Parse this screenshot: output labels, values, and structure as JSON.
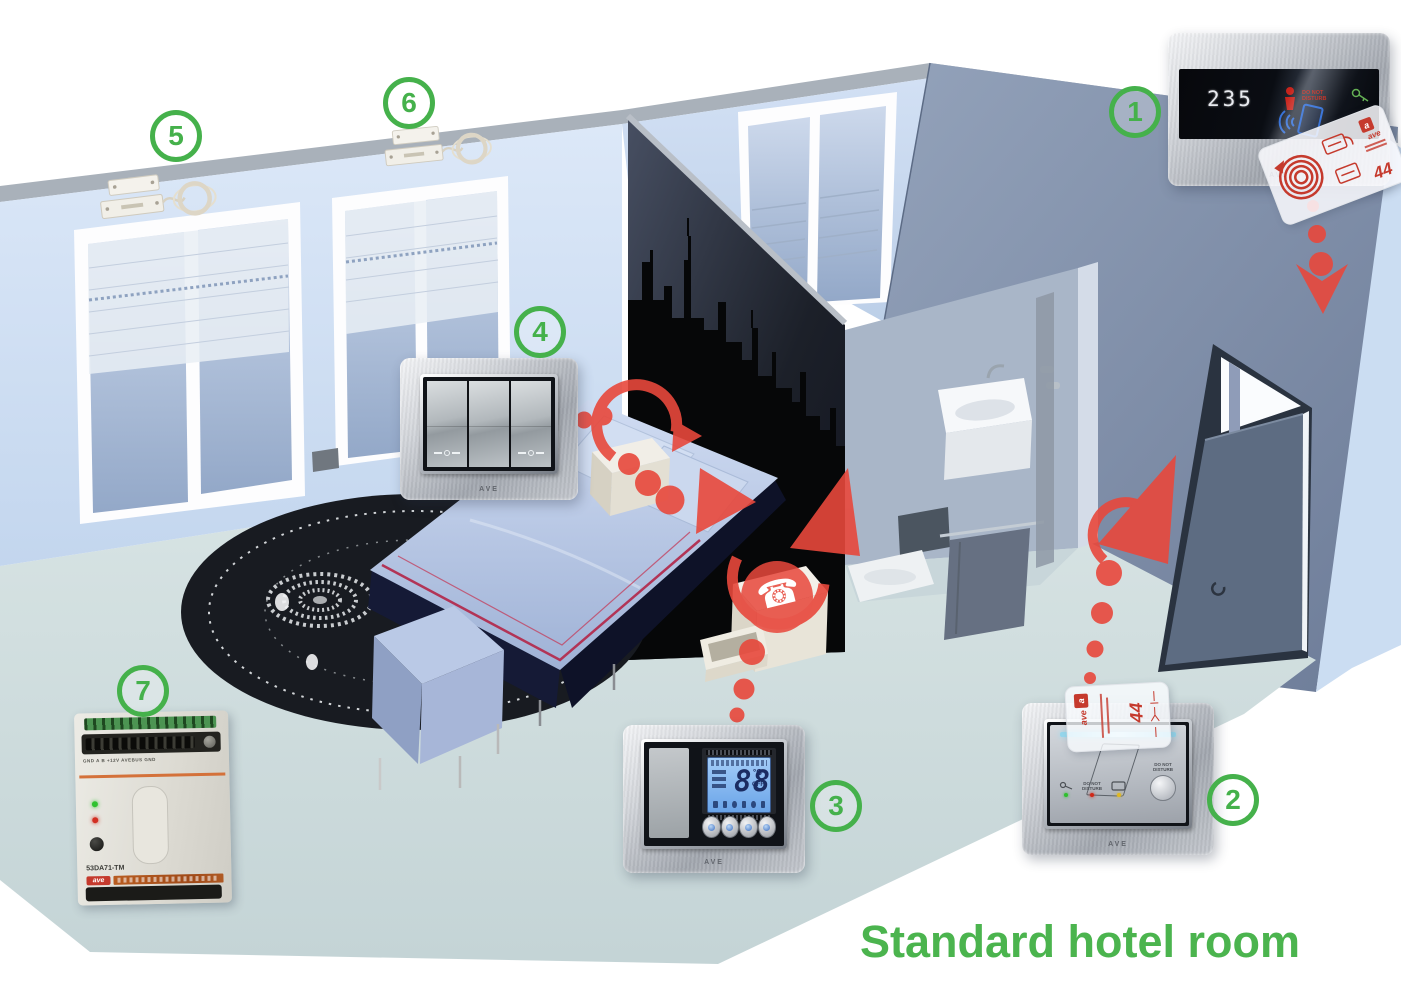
{
  "title": {
    "text": "Standard hotel room"
  },
  "badges": [
    "1",
    "2",
    "3",
    "4",
    "5",
    "6",
    "7"
  ],
  "brand": {
    "panel": "AVE",
    "module": "ave",
    "logo_letter": "a"
  },
  "icons": {
    "phone": "☎"
  },
  "dnd": {
    "line1": "DO NOT",
    "line2": "DISTURB"
  },
  "access_reader": {
    "room_number": "235"
  },
  "keycard": {
    "number": "44",
    "brand": "ave"
  },
  "thermostat": {
    "reading": "888",
    "unit": "°C",
    "off_label": "OFF"
  },
  "din_module": {
    "model": "53DA71-TM",
    "terminals": "GND A B +12V AVEBUS GND"
  },
  "colors": {
    "badge_green": "#45b14b",
    "title_green": "#4bb44e",
    "arrow_red": "#e8483c",
    "lcd_blue": "#6aa4e8",
    "card_red": "#c53a2d",
    "wall_light_blue": "#d5e2f4",
    "mural_dark": "#14171e",
    "floor": "#ccdada"
  }
}
